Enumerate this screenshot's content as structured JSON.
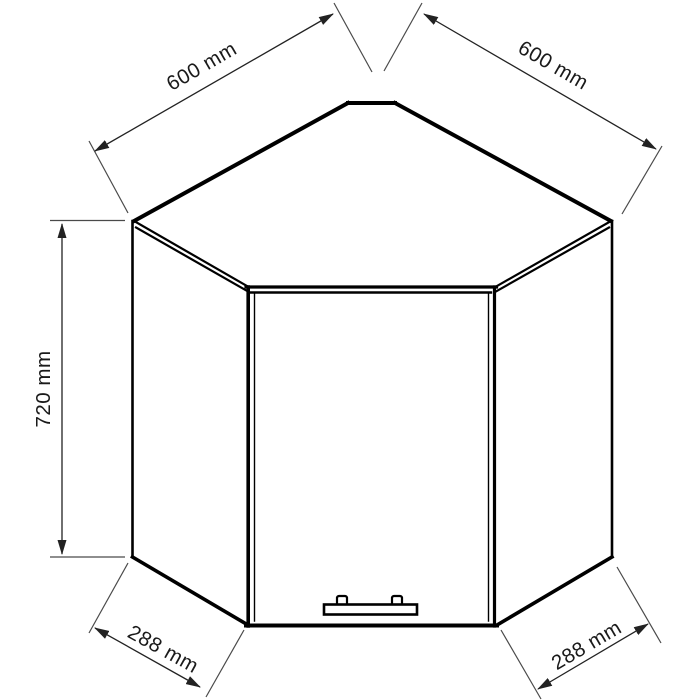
{
  "page": {
    "background_color": "#ffffff"
  },
  "diagram": {
    "unit": "mm",
    "cabinet_line_color": "#000000",
    "dimension_line_color": "#222222",
    "extension_line_color": "#4a4a4a",
    "text_color": "#1a1a1a",
    "handle_fill_color": "#ffffff",
    "dimensions": {
      "top_left_depth": {
        "label": "600 mm",
        "value": 600
      },
      "top_right_depth": {
        "label": "600 mm",
        "value": 600
      },
      "height": {
        "label": "720 mm",
        "value": 720
      },
      "front_left_width": {
        "label": "288 mm",
        "value": 288
      },
      "front_right_width": {
        "label": "288 mm",
        "value": 288
      }
    }
  }
}
